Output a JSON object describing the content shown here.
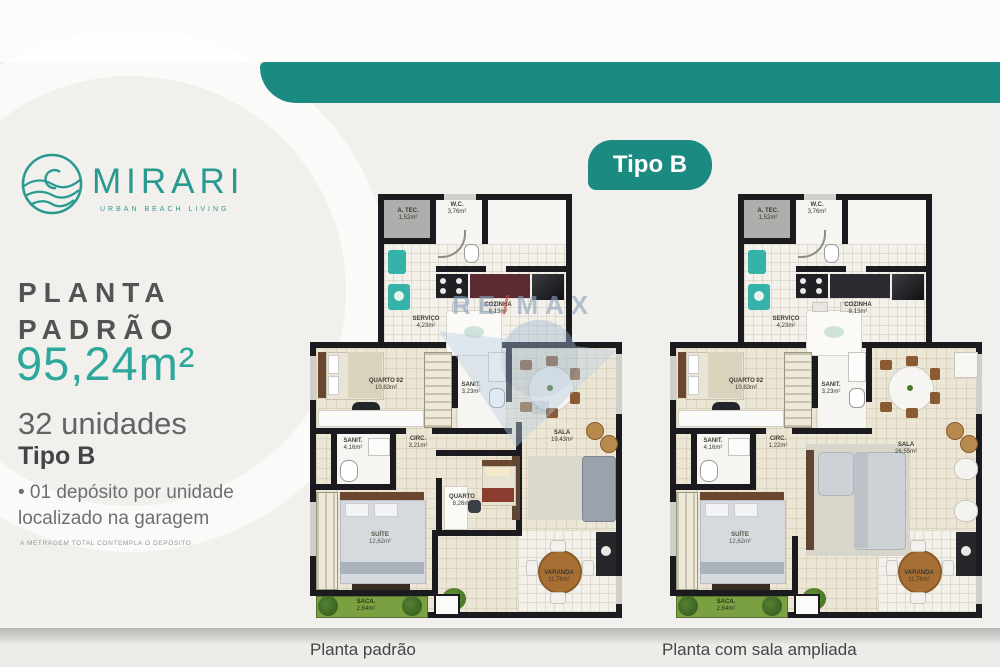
{
  "brand": {
    "name": "MIRARI",
    "tagline": "URBAN BEACH LIVING"
  },
  "panel": {
    "title_line1": "PLANTA",
    "title_line2": "PADRÃO",
    "area": "95,24m²",
    "units": "32 unidades",
    "type_label": "Tipo B",
    "bullet_line1": "• 01 depósito por unidade",
    "bullet_line2": "localizado na garagem",
    "footnote": "A METRAGEM TOTAL CONTEMPLA O DEPÓSITO"
  },
  "badge": {
    "label": "Tipo B"
  },
  "watermark": {
    "re": "RE",
    "slash": "/",
    "max": "MAX"
  },
  "plans": [
    {
      "caption": "Planta padrão",
      "rooms": {
        "atec": {
          "name": "A. TEC.",
          "area": "1,52m²"
        },
        "wc": {
          "name": "W.C.",
          "area": "3,76m²"
        },
        "servico": {
          "name": "SERVIÇO",
          "area": "4,23m²"
        },
        "cozinha": {
          "name": "COZINHA",
          "area": "8,13m²"
        },
        "quarto02": {
          "name": "QUARTO 02",
          "area": "10,63m²"
        },
        "sanit1": {
          "name": "SANIT.",
          "area": "3,23m²"
        },
        "sala": {
          "name": "SALA",
          "area": "19,43m²"
        },
        "circ": {
          "name": "CIRC.",
          "area": "3,21m²"
        },
        "sanit2": {
          "name": "SANIT.",
          "area": "4,16m²"
        },
        "suite": {
          "name": "SUÍTE",
          "area": "12,62m²"
        },
        "quarto": {
          "name": "QUARTO",
          "area": "8,26m²"
        },
        "varanda": {
          "name": "VARANDA",
          "area": "11,76m²"
        },
        "sacada": {
          "name": "SACA.",
          "area": "2,64m²"
        }
      }
    },
    {
      "caption": "Planta com sala ampliada",
      "rooms": {
        "atec": {
          "name": "A. TEC.",
          "area": "1,52m²"
        },
        "wc": {
          "name": "W.C.",
          "area": "3,76m²"
        },
        "servico": {
          "name": "SERVIÇO",
          "area": "4,23m²"
        },
        "cozinha": {
          "name": "COZINHA",
          "area": "8,13m²"
        },
        "quarto02": {
          "name": "QUARTO 02",
          "area": "10,63m²"
        },
        "sanit1": {
          "name": "SANIT.",
          "area": "3,23m²"
        },
        "sala": {
          "name": "SALA",
          "area": "26,55m²"
        },
        "circ": {
          "name": "CIRC.",
          "area": "1,22m²"
        },
        "sanit2": {
          "name": "SANIT.",
          "area": "4,16m²"
        },
        "suite": {
          "name": "SUÍTE",
          "area": "12,62m²"
        },
        "varanda": {
          "name": "VARANDA",
          "area": "11,76m²"
        },
        "sacada": {
          "name": "SACA.",
          "area": "2,64m²"
        }
      }
    }
  ],
  "colors": {
    "teal": "#1b8a81",
    "logo_teal": "#2a9a91",
    "area_teal": "#2ea79d"
  }
}
